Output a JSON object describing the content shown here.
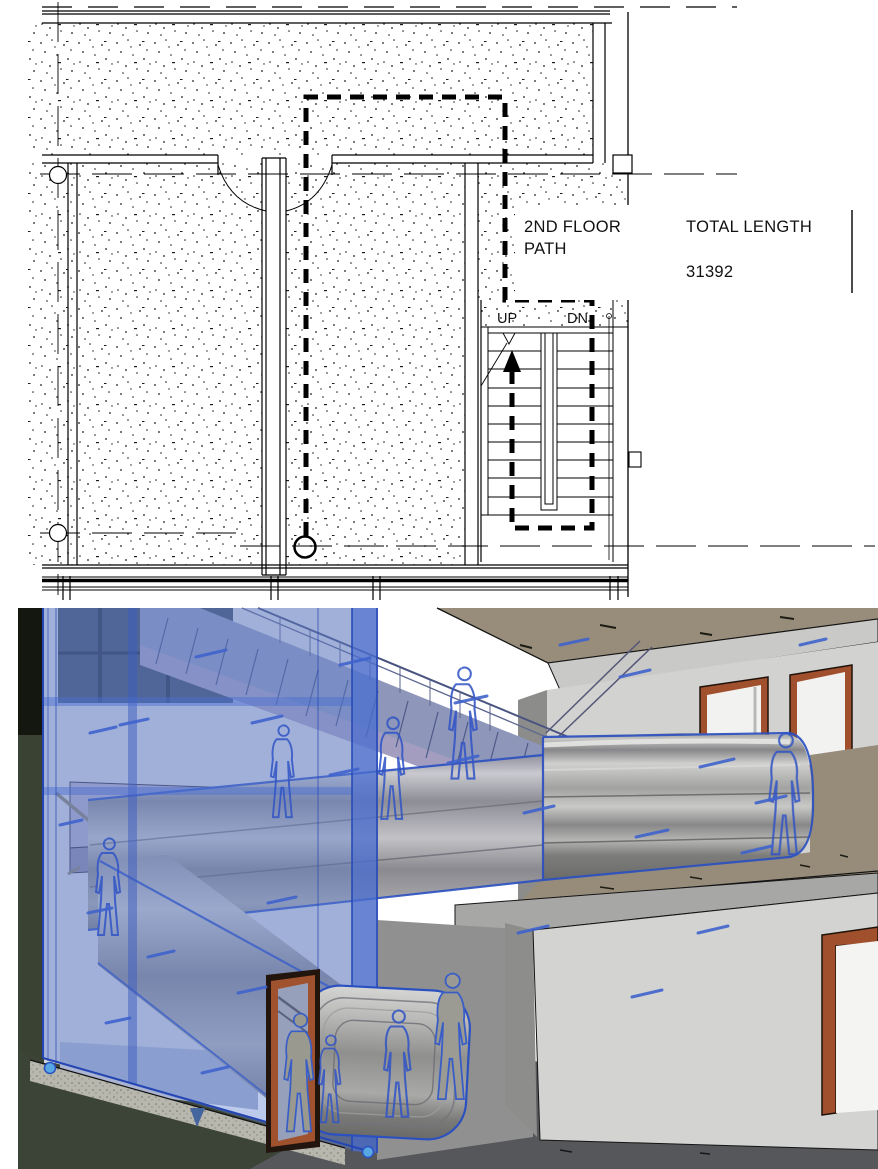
{
  "app_context": "BIM floor plan with path-of-travel analysis and 3D section view",
  "plan": {
    "callout": {
      "line1": "2ND FLOOR",
      "line2": "PATH",
      "total_label": "TOTAL LENGTH",
      "total_value": "31392"
    },
    "stair": {
      "up": "UP",
      "down": "DN"
    }
  },
  "view3d": {
    "selection": "path-of-travel sweep and section glass highlighted",
    "grip_count": 2
  },
  "colors": {
    "line_black": "#000000",
    "selection_blue": "#2b50c0",
    "glass_blue": "#5f80d2",
    "mark_blue": "#3f63cc",
    "grip_blue": "#57a7e3",
    "door_brown": "#a0522e",
    "floor_tan": "#978c7a",
    "wall_light_gray": "#d3d3d2",
    "slab_gray": "#a7a7a5",
    "ground_dark_gray": "#56575a",
    "background_olive": "#3c4437",
    "stair_lavender": "#a39ec0"
  }
}
